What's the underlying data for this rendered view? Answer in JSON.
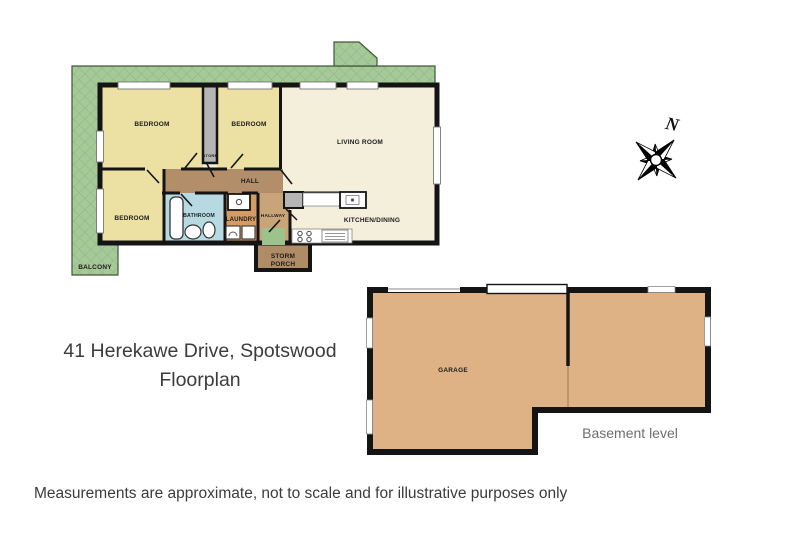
{
  "page": {
    "title_line1": "41 Herekawe Drive, Spotswood",
    "title_line2": "Floorplan",
    "disclaimer": "Measurements are approximate, not to scale and for illustrative purposes only"
  },
  "compass": {
    "north_label": "N"
  },
  "main_floor": {
    "balcony": "BALCONY",
    "bedroom_top_left": "BEDROOM",
    "bedroom_top_middle": "BEDROOM",
    "bedroom_bottom_left": "BEDROOM",
    "store": "STORE",
    "living_room": "LIVING ROOM",
    "hall": "HALL",
    "bathroom": "BATHROOM",
    "laundry": "LAUNDRY",
    "hallway": "HALLWAY",
    "kitchen_dining": "KITCHEN/DINING",
    "storm_porch_line1": "STORM",
    "storm_porch_line2": "PORCH"
  },
  "basement": {
    "garage": "GARAGE",
    "level_label": "Basement level"
  },
  "colors": {
    "balcony_green": "#a6c998",
    "balcony_hatch": "#8fb383",
    "room_yellow": "#ece0a3",
    "room_cream": "#f4efdb",
    "hall_brown": "#b28f6a",
    "hallway_brown": "#c8a478",
    "bathroom_blue": "#b7dae2",
    "laundry_orange": "#d49b63",
    "porch_brown": "#b08c66",
    "mat_green": "#9cc28e",
    "garage_tan": "#dfb286",
    "store_gray": "#b5b5b5",
    "wall_black": "#141414"
  }
}
